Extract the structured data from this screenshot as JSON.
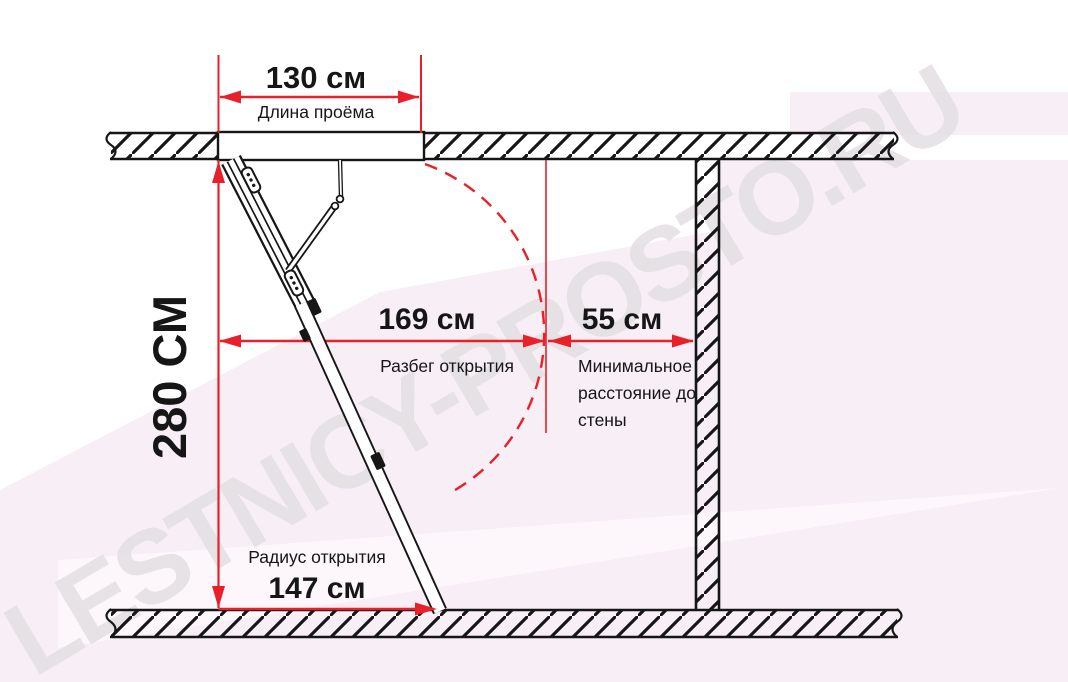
{
  "watermark": {
    "text": "LESTNICY-PROSTO.RU"
  },
  "dimensions": {
    "opening_length": {
      "value": "130 см",
      "label": "Длина проёма"
    },
    "ceiling_height": {
      "value": "280 СМ"
    },
    "opening_run": {
      "value": "169 см",
      "label": "Разбег открытия"
    },
    "wall_distance": {
      "value": "55 см",
      "label": "Минимальное расстояние до стены"
    },
    "opening_radius": {
      "value": "147 см",
      "label": "Радиус открытия"
    }
  },
  "colors": {
    "dimension_red": "#e8202a",
    "linework_black": "#161616",
    "watermark_gray": "#e3dfe3",
    "background_pink": "#f8eef5",
    "background_pink_light": "#fdf7fb"
  }
}
